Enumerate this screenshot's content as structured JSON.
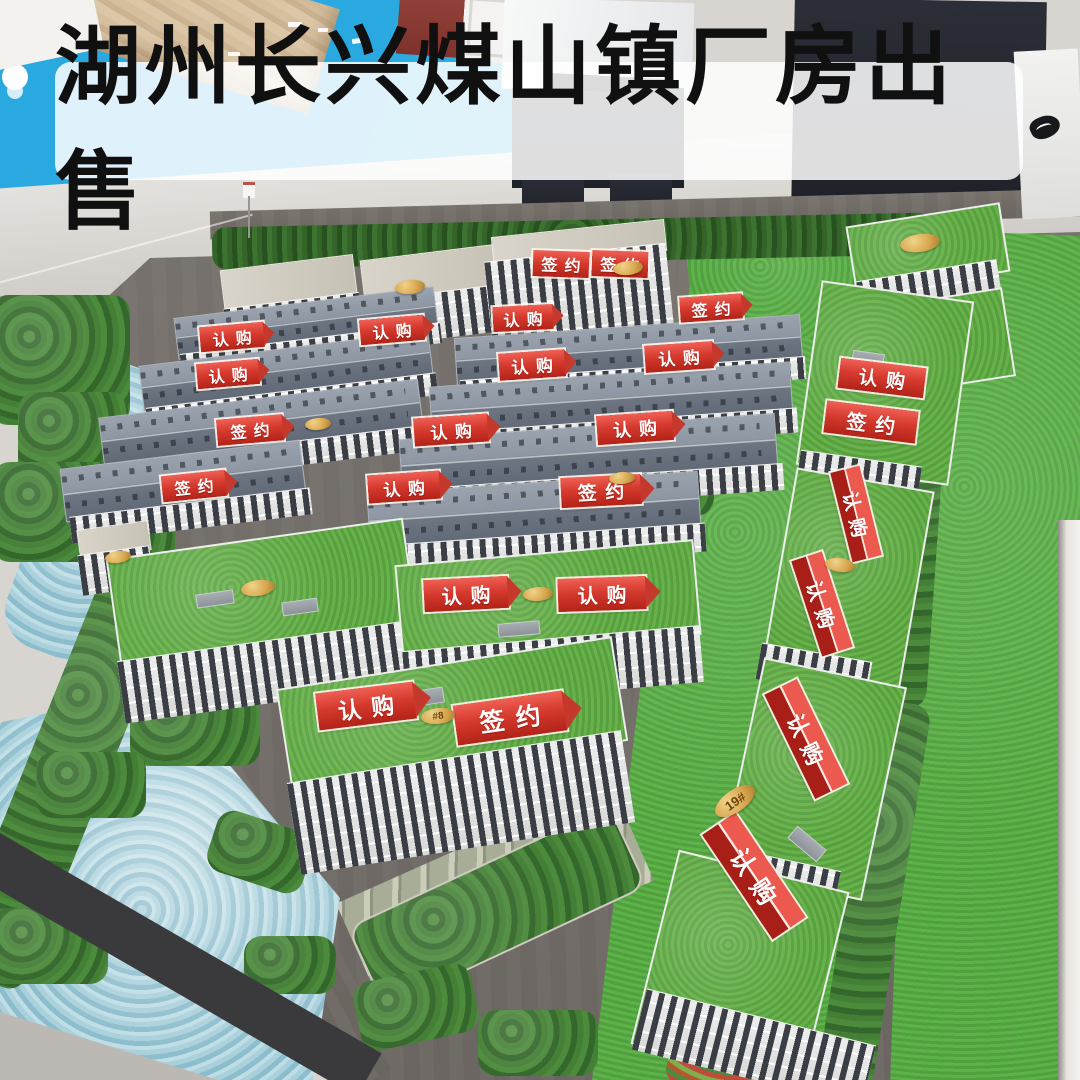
{
  "title_banner": {
    "text": "湖州长兴煤山镇厂房出售"
  },
  "banner_labels": {
    "reserved": "认购",
    "signed": "签约"
  },
  "banners": [
    {
      "text": "认购",
      "type": "arrow",
      "cx": 232,
      "cy": 337,
      "w": 64,
      "h": 25,
      "r": -5
    },
    {
      "text": "认购",
      "type": "arrow",
      "cx": 392,
      "cy": 330,
      "w": 64,
      "h": 25,
      "r": -5
    },
    {
      "text": "认购",
      "type": "arrow",
      "cx": 523,
      "cy": 318,
      "w": 60,
      "h": 25,
      "r": -3
    },
    {
      "text": "签约",
      "type": "flat",
      "cx": 561,
      "cy": 264,
      "w": 56,
      "h": 26,
      "r": 2
    },
    {
      "text": "签约",
      "type": "flat",
      "cx": 620,
      "cy": 264,
      "w": 56,
      "h": 26,
      "r": 2
    },
    {
      "text": "签约",
      "type": "arrow",
      "cx": 711,
      "cy": 308,
      "w": 62,
      "h": 25,
      "r": -4
    },
    {
      "text": "认购",
      "type": "arrow",
      "cx": 679,
      "cy": 357,
      "w": 68,
      "h": 27,
      "r": -4
    },
    {
      "text": "认购",
      "type": "arrow",
      "cx": 228,
      "cy": 374,
      "w": 62,
      "h": 25,
      "r": -5
    },
    {
      "text": "认购",
      "type": "arrow",
      "cx": 532,
      "cy": 365,
      "w": 66,
      "h": 27,
      "r": -4
    },
    {
      "text": "签约",
      "type": "arrow",
      "cx": 250,
      "cy": 430,
      "w": 66,
      "h": 26,
      "r": -5
    },
    {
      "text": "认购",
      "type": "arrow",
      "cx": 451,
      "cy": 430,
      "w": 74,
      "h": 28,
      "r": -4
    },
    {
      "text": "认购",
      "type": "arrow",
      "cx": 635,
      "cy": 428,
      "w": 76,
      "h": 29,
      "r": -4
    },
    {
      "text": "认购",
      "type": "flat",
      "cx": 882,
      "cy": 378,
      "w": 86,
      "h": 30,
      "r": 7
    },
    {
      "text": "签约",
      "type": "flat",
      "cx": 871,
      "cy": 422,
      "w": 92,
      "h": 32,
      "r": 7
    },
    {
      "text": "签约",
      "type": "arrow",
      "cx": 194,
      "cy": 486,
      "w": 64,
      "h": 26,
      "r": -6
    },
    {
      "text": "认购",
      "type": "arrow",
      "cx": 404,
      "cy": 487,
      "w": 72,
      "h": 28,
      "r": -4
    },
    {
      "text": "签约",
      "type": "arrow",
      "cx": 601,
      "cy": 491,
      "w": 80,
      "h": 30,
      "r": -3
    },
    {
      "text": "认购",
      "type": "arrow",
      "cx": 466,
      "cy": 594,
      "w": 84,
      "h": 32,
      "r": -3
    },
    {
      "text": "认购",
      "type": "arrow",
      "cx": 602,
      "cy": 594,
      "w": 88,
      "h": 33,
      "r": -2
    },
    {
      "text": "认购",
      "type": "arrow",
      "cx": 366,
      "cy": 706,
      "w": 98,
      "h": 37,
      "r": -7
    },
    {
      "text": "签约",
      "type": "arrow",
      "cx": 510,
      "cy": 718,
      "w": 110,
      "h": 40,
      "r": -8
    },
    {
      "text": "认购",
      "type": "tent",
      "cx": 856,
      "cy": 514,
      "w": 92,
      "h": 30,
      "r": 76
    },
    {
      "text": "认购",
      "type": "tent",
      "cx": 822,
      "cy": 604,
      "w": 100,
      "h": 32,
      "r": 72
    },
    {
      "text": "认购",
      "type": "tent",
      "cx": 806,
      "cy": 739,
      "w": 116,
      "h": 36,
      "r": 64
    },
    {
      "text": "认购",
      "type": "tent",
      "cx": 754,
      "cy": 876,
      "w": 126,
      "h": 40,
      "r": 56
    }
  ],
  "plaques": [
    {
      "text": "",
      "cx": 410,
      "cy": 287,
      "w": 30,
      "h": 14,
      "r": -6
    },
    {
      "text": "",
      "cx": 628,
      "cy": 268,
      "w": 30,
      "h": 14,
      "r": -6
    },
    {
      "text": "",
      "cx": 920,
      "cy": 243,
      "w": 40,
      "h": 18,
      "r": -8
    },
    {
      "text": "",
      "cx": 318,
      "cy": 424,
      "w": 26,
      "h": 12,
      "r": -5
    },
    {
      "text": "",
      "cx": 622,
      "cy": 478,
      "w": 26,
      "h": 12,
      "r": -4
    },
    {
      "text": "",
      "cx": 258,
      "cy": 588,
      "w": 34,
      "h": 16,
      "r": -8
    },
    {
      "text": "",
      "cx": 118,
      "cy": 557,
      "w": 26,
      "h": 12,
      "r": -8
    },
    {
      "text": "",
      "cx": 538,
      "cy": 594,
      "w": 30,
      "h": 14,
      "r": -4
    },
    {
      "text": "#8",
      "cx": 438,
      "cy": 716,
      "w": 34,
      "h": 16,
      "r": -6
    },
    {
      "text": "19#",
      "cx": 735,
      "cy": 801,
      "w": 46,
      "h": 22,
      "r": -35
    },
    {
      "text": "",
      "cx": 840,
      "cy": 565,
      "w": 30,
      "h": 14,
      "r": 8
    }
  ],
  "colors": {
    "banner_red": "#d63a2e",
    "banner_text": "#ffffff",
    "title_text": "#101010",
    "title_bg": "rgba(255,255,255,0.85)",
    "wall_blue": "#2aa9e0",
    "grass_roof": "#67b24a",
    "lawn": "#5cb348",
    "road": "#736e69",
    "water": "#9ec9d6",
    "plaque_gold": "#d8a74e"
  }
}
